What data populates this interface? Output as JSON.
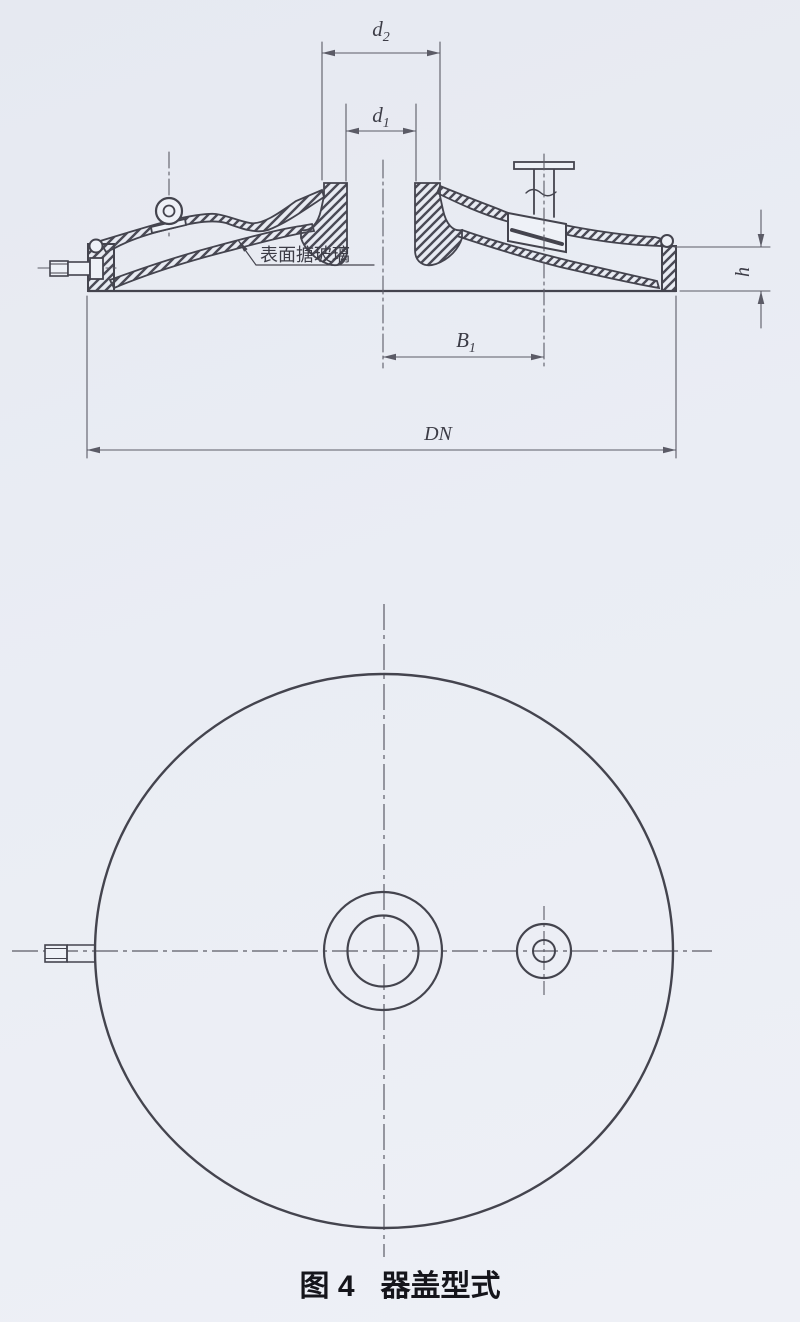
{
  "colors": {
    "background": "#e9ecf3",
    "paper": "#eef1f7",
    "line": "#44444e",
    "dim_line": "#5b5b66",
    "text": "#3c3c46",
    "caption": "#15151b"
  },
  "section_view": {
    "dim_d2": {
      "symbol": "d",
      "subscript": "2"
    },
    "dim_d1": {
      "symbol": "d",
      "subscript": "1"
    },
    "dim_B1": {
      "symbol": "B",
      "subscript": "1"
    },
    "dim_DN": "DN",
    "dim_h": "h",
    "surface_note": "表面搪玻璃"
  },
  "caption": {
    "figure_label": "图 4",
    "title": "器盖型式"
  }
}
